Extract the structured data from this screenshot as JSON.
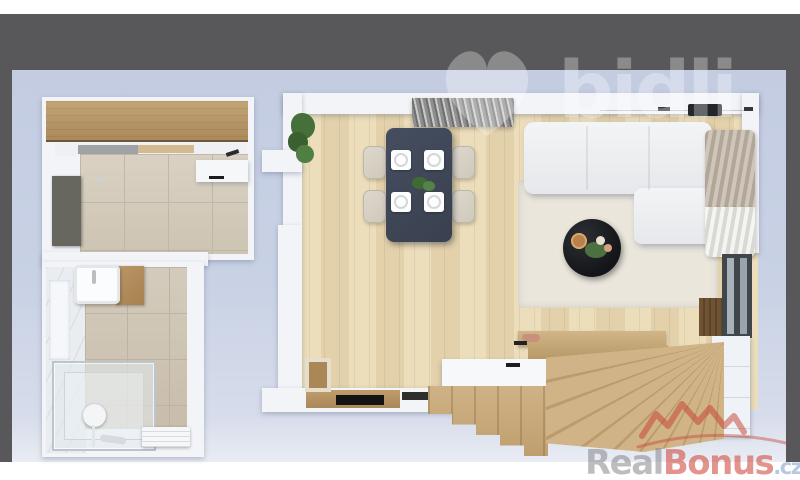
{
  "image": {
    "type": "3d-floorplan-render",
    "view": "top-down-apartment"
  },
  "watermarks": {
    "bidli": {
      "text": "bidli",
      "icon": "heart-icon"
    },
    "realbonus": {
      "brand_real": "Real",
      "brand_bonus": "Bonus",
      "brand_tld": ".cz",
      "icon": "houses-roofline-icon"
    }
  },
  "palette": {
    "frame_gray": "#58585a",
    "page_white": "#ffffff",
    "ambient_blue": "#c7d0e3",
    "wall_white": "#f2f4f8",
    "wood_floor": "#e9d8b0",
    "tile_beige": "#d2c9ba",
    "stair_wood": "#c6a97a",
    "cabinet_wood": "#b3946a",
    "dining_table_navy": "#3e4656",
    "coffee_table_black": "#17191c",
    "watermark_red": "#ce4639"
  },
  "scene": {
    "rooms": [
      {
        "name": "kitchen"
      },
      {
        "name": "bathroom"
      },
      {
        "name": "living-dining-room"
      },
      {
        "name": "staircase"
      }
    ]
  }
}
